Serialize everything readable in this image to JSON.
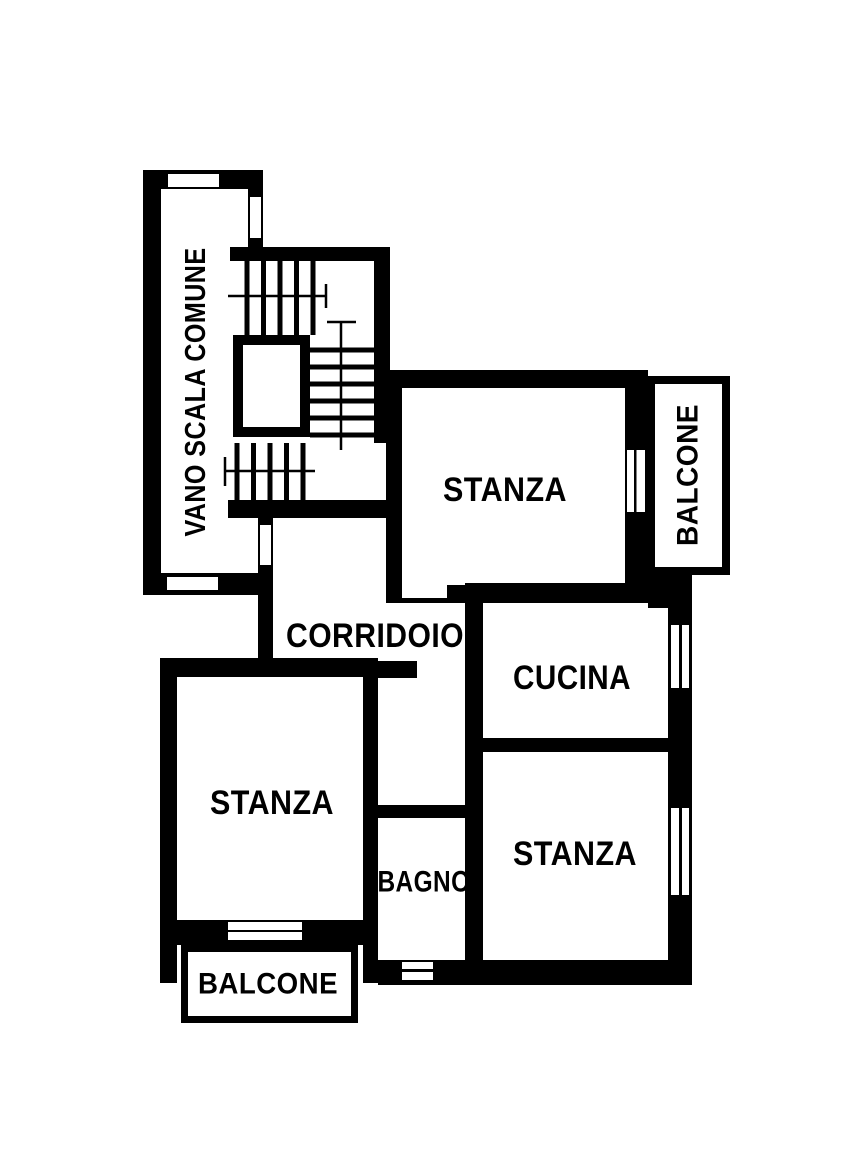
{
  "plan": {
    "type": "apartment-floor-plan",
    "colors": {
      "wall": "#000000",
      "background": "#ffffff"
    },
    "rooms": [
      {
        "name": "vano-scala-comune",
        "label": "VANO SCALA COMUNE"
      },
      {
        "name": "stanza-nord",
        "label": "STANZA"
      },
      {
        "name": "balcone-est",
        "label": "BALCONE"
      },
      {
        "name": "corridoio",
        "label": "CORRIDOIO"
      },
      {
        "name": "cucina",
        "label": "CUCINA"
      },
      {
        "name": "stanza-ovest",
        "label": "STANZA"
      },
      {
        "name": "bagno",
        "label": "BAGNO"
      },
      {
        "name": "stanza-sud",
        "label": "STANZA"
      },
      {
        "name": "balcone-sud",
        "label": "BALCONE"
      }
    ]
  }
}
